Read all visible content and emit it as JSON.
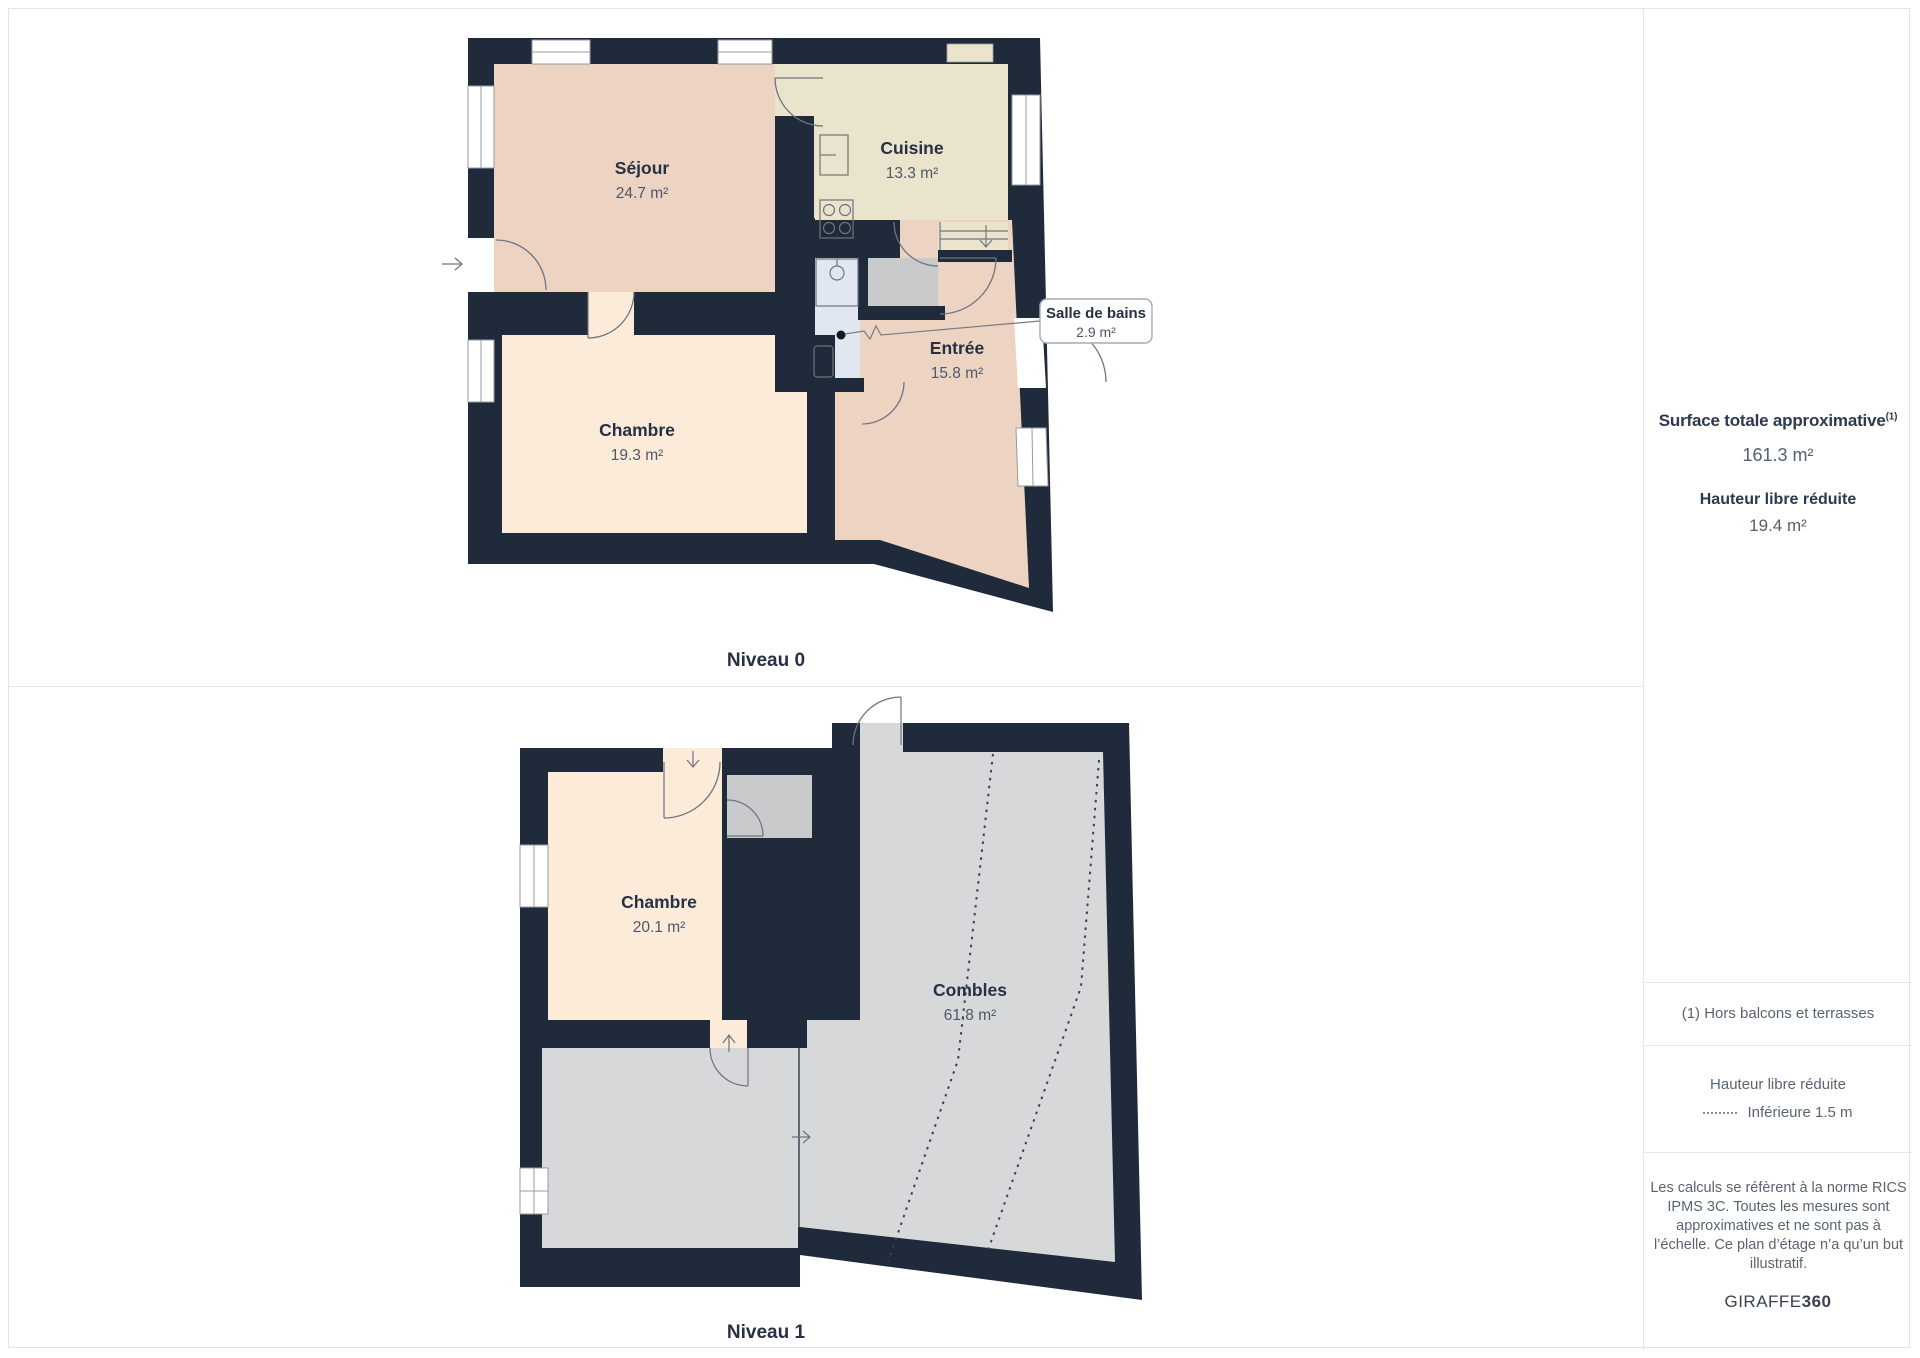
{
  "levels": [
    {
      "caption": "Niveau 0",
      "rooms": {
        "sejour": {
          "name": "Séjour",
          "area": "24.7 m²"
        },
        "cuisine": {
          "name": "Cuisine",
          "area": "13.3 m²"
        },
        "chambre": {
          "name": "Chambre",
          "area": "19.3 m²"
        },
        "entree": {
          "name": "Entrée",
          "area": "15.8 m²"
        }
      },
      "callout": {
        "name": "Salle de bains",
        "area": "2.9 m²"
      }
    },
    {
      "caption": "Niveau 1",
      "rooms": {
        "chambre": {
          "name": "Chambre",
          "area": "20.1 m²"
        },
        "combles": {
          "name": "Combles",
          "area": "61.8 m²"
        }
      }
    }
  ],
  "sidebar": {
    "surface_title": "Surface totale approximative",
    "surface_title_sup": "(1)",
    "surface_value": "161.3 m²",
    "reduced_height_title": "Hauteur libre réduite",
    "reduced_height_value": "19.4 m²",
    "footnote": "(1) Hors balcons et terrasses",
    "legend_title": "Hauteur libre réduite",
    "legend_item": "Inférieure 1.5 m",
    "disclaimer": "Les calculs se réfèrent à la norme RICS IPMS 3C. Toutes les mesures sont approximatives et ne sont pas à l’échelle. Ce plan d’étage n’a qu’un but illustratif.",
    "brand": {
      "name": "GIRAFFE",
      "suffix": "360"
    }
  },
  "colors": {
    "wall": "#1f2b3a",
    "room_pink": "#edd3c2",
    "room_beige": "#eae4cc",
    "room_cream": "#fcebd8",
    "room_gray": "#d7d8d9",
    "closet_gray": "#c9cacc",
    "bathroom_blue": "#e1e7f1"
  }
}
